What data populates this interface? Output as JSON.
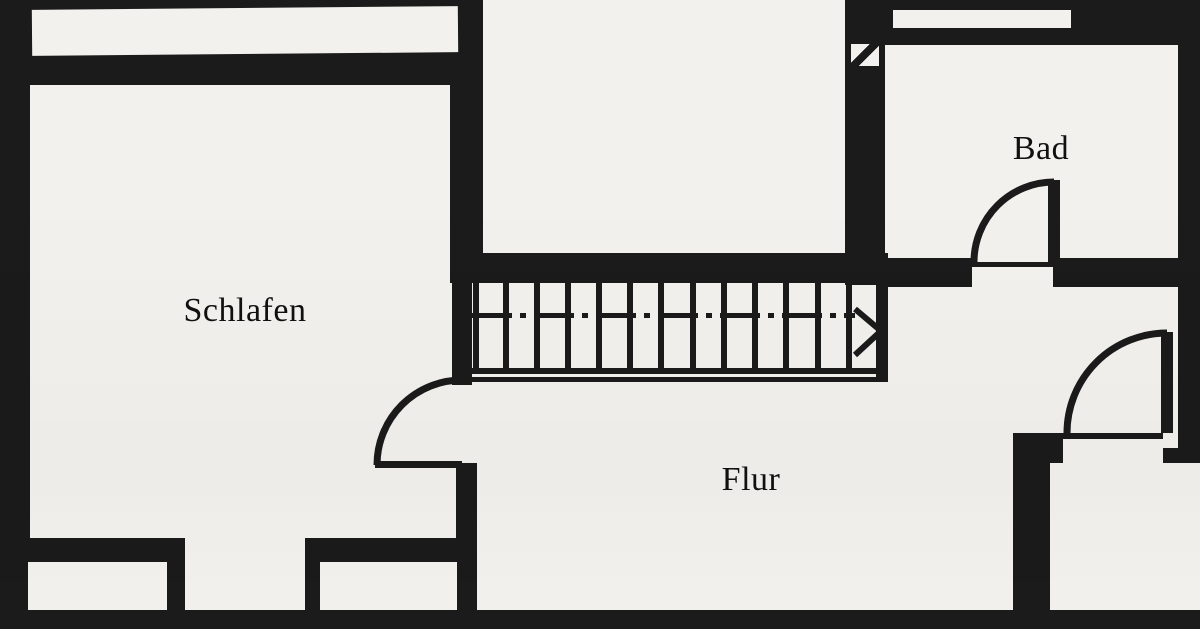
{
  "rooms": {
    "schlafen": {
      "label": "Schlafen"
    },
    "flur": {
      "label": "Flur"
    },
    "bad": {
      "label": "Bad"
    }
  },
  "symbols": {
    "staircase_direction": "arrow-right",
    "doors": [
      "bad-door",
      "schlafen-door",
      "right-room-door"
    ],
    "flue": "flue-vent-square"
  },
  "colors": {
    "wall": "#1b1b1b",
    "paper": "#f6f4f0",
    "ink": "#101010"
  }
}
